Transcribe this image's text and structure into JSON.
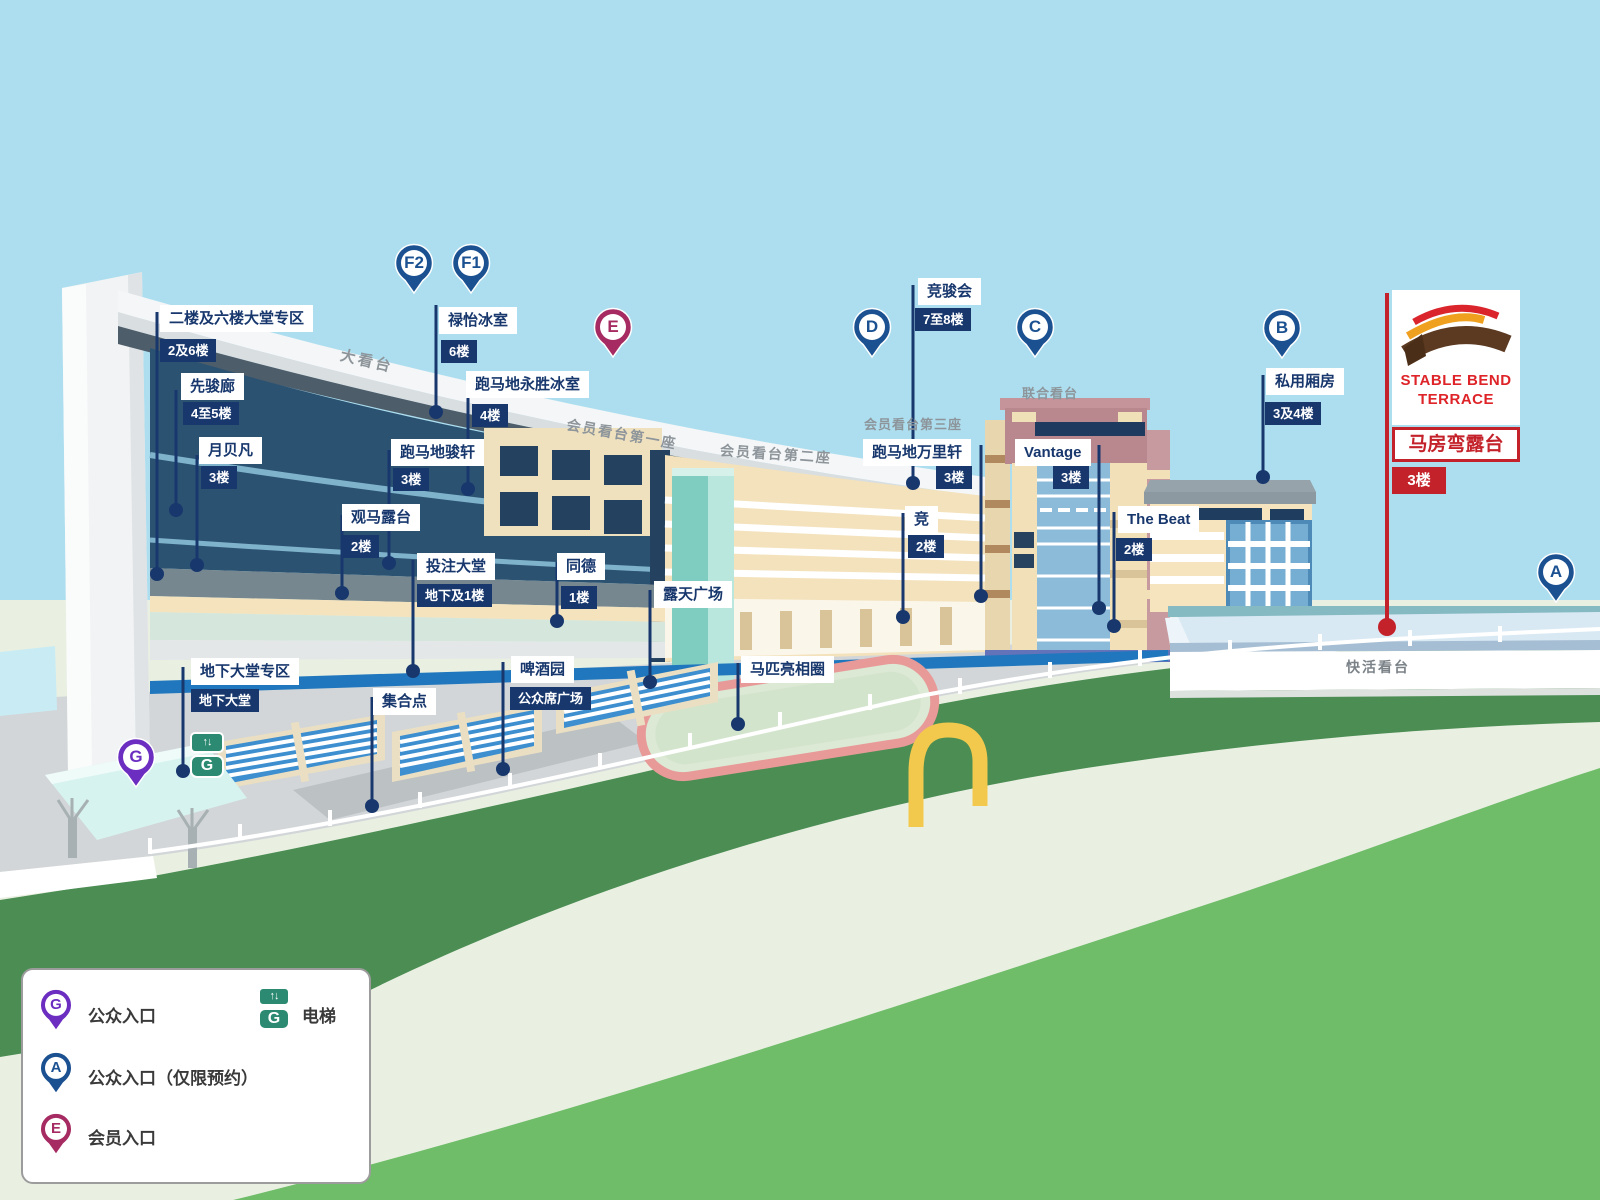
{
  "pins": {
    "f2": "F2",
    "f1": "F1",
    "e": "E",
    "d": "D",
    "c": "C",
    "b": "B",
    "a": "A",
    "g": "G"
  },
  "building_labels": {
    "grandstand": "大看台",
    "members_stand_1": "会员看台第一座",
    "members_stand_2": "会员看台第二座",
    "members_stand_3": "会员看台第三座",
    "united_stand": "联合看台",
    "happy_stand": "快活看台"
  },
  "locations": {
    "lobby_2_6": {
      "name": "二楼及六楼大堂专区",
      "floor": "2及6楼"
    },
    "pioneers": {
      "name": "先骏廊",
      "floor": "4至5楼"
    },
    "moon_koon": {
      "name": "月贝凡",
      "floor": "3楼"
    },
    "luk_yi": {
      "name": "禄怡冰室",
      "floor": "6楼"
    },
    "wing_sing": {
      "name": "跑马地永胜冰室",
      "floor": "4楼"
    },
    "chun_hin": {
      "name": "跑马地骏轩",
      "floor": "3楼"
    },
    "terrace_2f": {
      "name": "观马露台",
      "floor": "2楼"
    },
    "betting_hall": {
      "name": "投注大堂",
      "floor": "地下及1楼"
    },
    "tung_tak": {
      "name": "同德",
      "floor": "1楼"
    },
    "open_plaza": {
      "name": "露天广场"
    },
    "beer_garden": {
      "name": "啤酒园",
      "floor": "公众席广场"
    },
    "meeting_point": {
      "name": "集合点"
    },
    "ground_lobby": {
      "name": "地下大堂专区",
      "floor": "地下大堂"
    },
    "parade_ring": {
      "name": "马匹亮相圈"
    },
    "racing_club": {
      "name": "竞骏会",
      "floor": "7至8楼"
    },
    "million_hin": {
      "name": "跑马地万里轩",
      "floor": "3楼"
    },
    "vantage": {
      "name": "Vantage",
      "floor": "3楼"
    },
    "gallery": {
      "name": "竞",
      "floor": "2楼"
    },
    "the_beat": {
      "name": "The Beat",
      "floor": "2楼"
    },
    "private_boxes": {
      "name": "私用厢房",
      "floor": "3及4楼"
    }
  },
  "stable_bend": {
    "logo_top": "STABLE BEND",
    "logo_bottom": "TERRACE",
    "name": "马房弯露台",
    "floor": "3楼"
  },
  "legend": {
    "public_entrance": "公众入口",
    "public_entrance_booking": "公众入口（仅限预约）",
    "member_entrance": "会员入口",
    "elevator": "电梯",
    "elevator_letter": "G",
    "elevator_arrows": "↑↓"
  },
  "colors": {
    "pin_blue": "#1B5191",
    "pin_purple": "#6B2EC0",
    "pin_maroon": "#A62B62",
    "accent_red": "#C4222A",
    "label_navy": "#17376D",
    "elevator_green": "#2B8A71",
    "track_green": "#4B8D53",
    "infield_green": "#E9F0E2",
    "lawn_green": "#6FBC69"
  }
}
